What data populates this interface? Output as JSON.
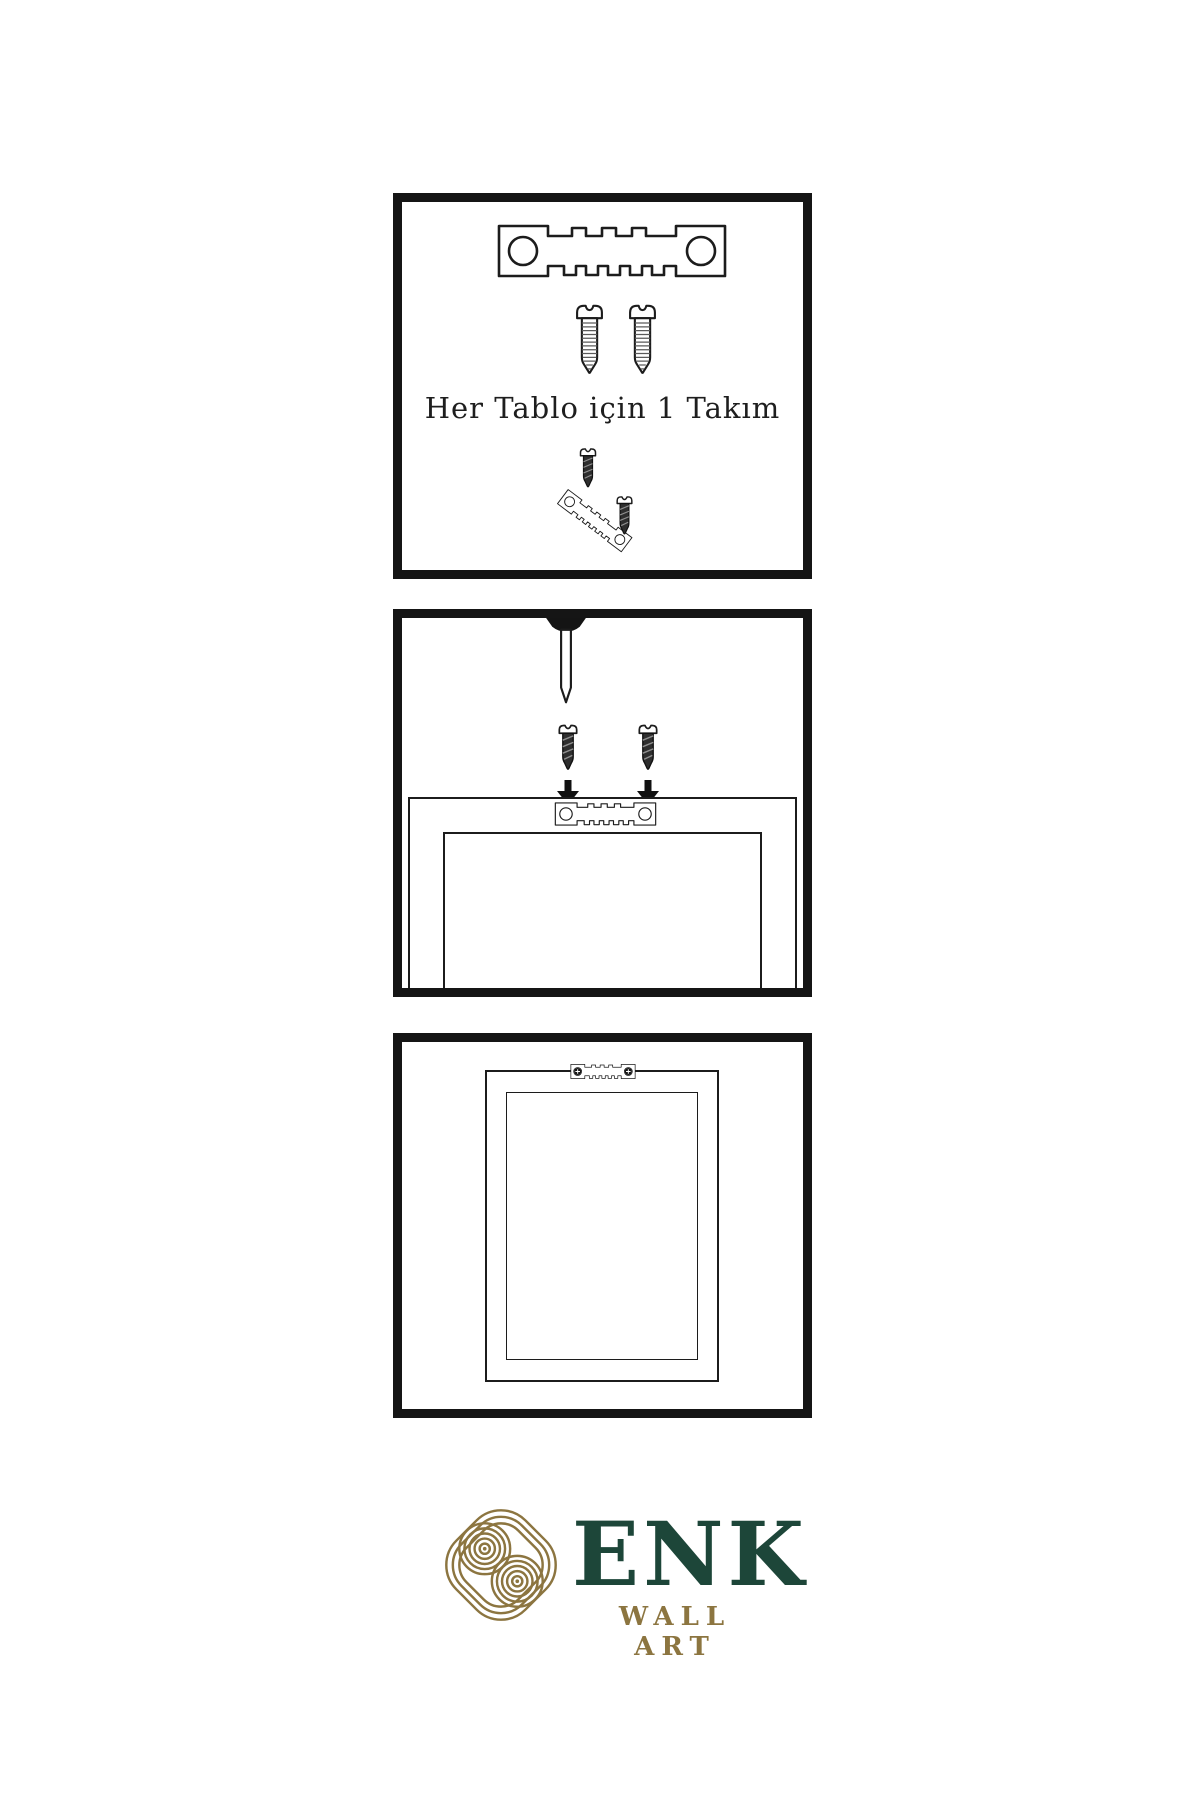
{
  "page": {
    "type": "product-instruction-sheet",
    "background": "#ffffff",
    "line_color": "#1c1c1c"
  },
  "steps": [
    {
      "caption": "Her Tablo için 1 Takım",
      "icons": [
        "sawtooth-hanger-icon",
        "screw-icon",
        "screw-icon",
        "dark-screw-icon",
        "tilted-sawtooth-hanger-icon"
      ]
    },
    {
      "icons": [
        "wall-nail-icon",
        "dark-screw-icon",
        "dark-screw-icon",
        "down-arrow-icon",
        "down-arrow-icon",
        "frame-back-icon",
        "sawtooth-hanger-icon"
      ]
    },
    {
      "icons": [
        "hung-frame-icon",
        "sawtooth-hanger-screwed-icon"
      ]
    }
  ],
  "brand": {
    "mark": "knot-icon",
    "name": "ENK",
    "name_letters": [
      "E",
      "N",
      "K"
    ],
    "subtitle": "WALL ART",
    "colors": {
      "gold": "#8c7540",
      "diamond_gold": "#9c7c34",
      "green": "#1d4639",
      "ink": "#151515"
    }
  }
}
